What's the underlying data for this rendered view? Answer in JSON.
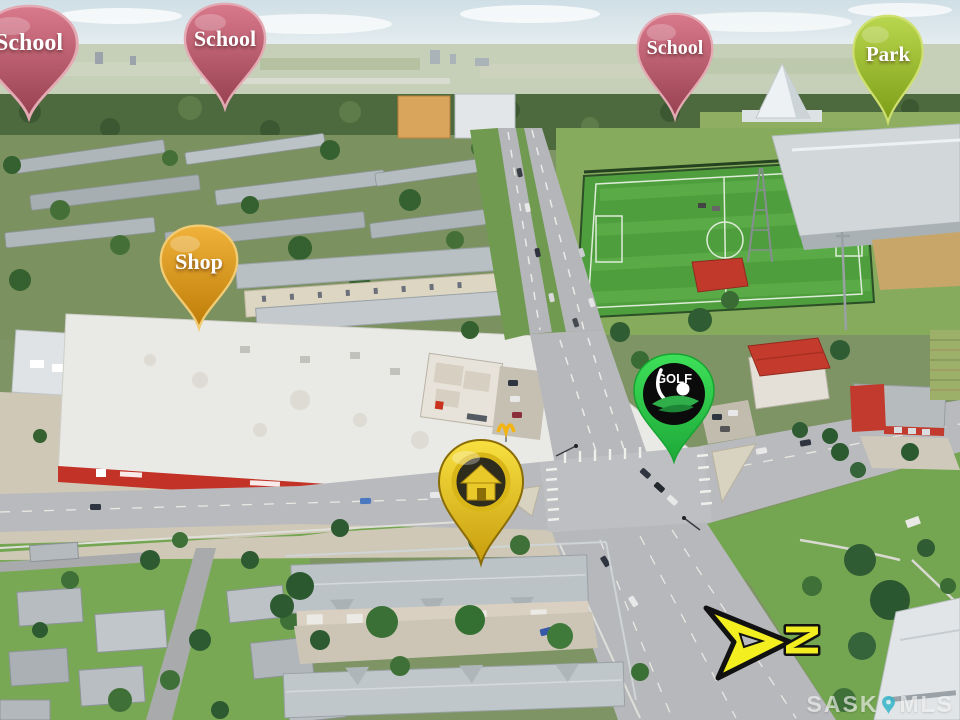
{
  "scene": {
    "type": "aerial-real-estate-photo",
    "watermark": {
      "left": "SASK",
      "right": "MLS",
      "pin_color": "#35b6c9"
    }
  },
  "pins": [
    {
      "id": "school-west",
      "label": "School",
      "color": "#c65a6e"
    },
    {
      "id": "school-north",
      "label": "School",
      "color": "#c65a6e"
    },
    {
      "id": "school-east",
      "label": "School",
      "color": "#c65a6e"
    },
    {
      "id": "park",
      "label": "Park",
      "color": "#9ab923"
    },
    {
      "id": "shop",
      "label": "Shop",
      "color": "#d99a12"
    },
    {
      "id": "golf",
      "label": "GOLF",
      "color": "#2bcf46"
    },
    {
      "id": "home",
      "color": "#e9c71f"
    }
  ],
  "compass": {
    "letter": "N",
    "color": "#f2ee1f"
  }
}
